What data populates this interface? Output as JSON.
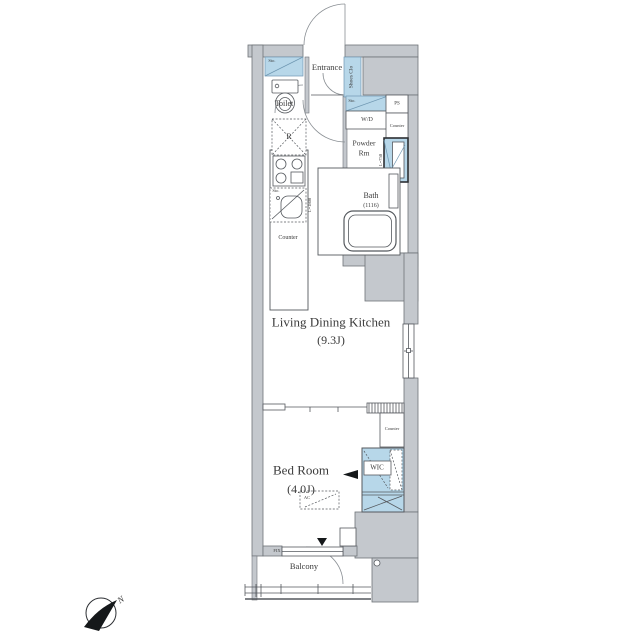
{
  "labels": {
    "toilet": "Toilet",
    "entrance": "Entrance",
    "shoes_clo": "Shoes Clo",
    "sto": "Sto.",
    "wd": "W/D",
    "ps": "PS",
    "counter": "Counter",
    "powder_1": "Powder",
    "powder_2": "Rm",
    "fridge": "R",
    "bath": "Bath",
    "bath_dim": "(1116)",
    "kitchen_len": "L=1800",
    "vanity_len": "L=750",
    "ldk": "Living Dining Kitchen",
    "ldk_size": "(9.3J)",
    "bedroom": "Bed Room",
    "bedroom_size": "(4.0J)",
    "wic": "WIC",
    "ac": "AC",
    "fix": "FIX",
    "balcony": "Balcony",
    "north": "N"
  },
  "colors": {
    "wall": "#c4c8cd",
    "wall_line": "#6e7378",
    "line": "#55595e",
    "blue": "#b7d7e9",
    "blue_line": "#6f97b2",
    "text": "#3b3b3b"
  }
}
